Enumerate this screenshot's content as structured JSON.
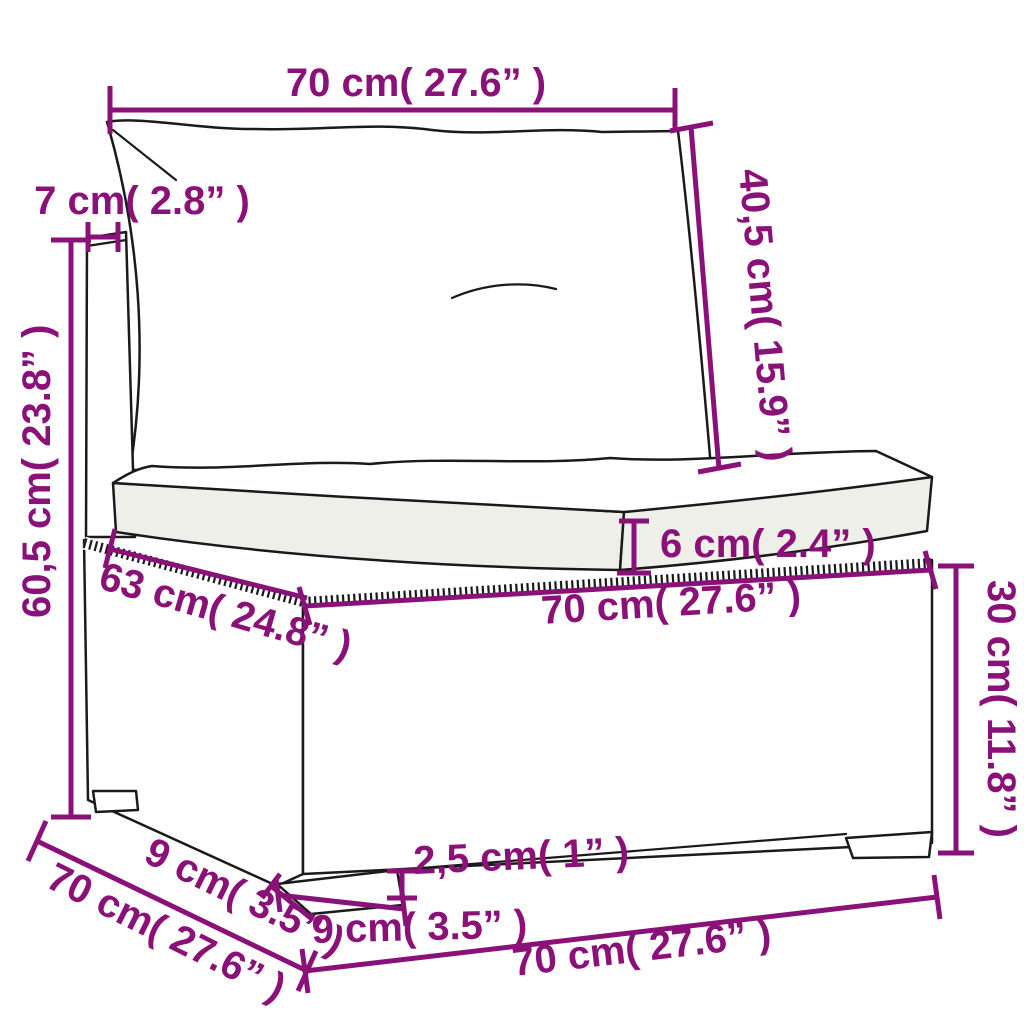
{
  "page": {
    "background": "#ffffff"
  },
  "diagram": {
    "type": "product-dimension-diagram",
    "subject": "poly rattan garden sofa middle section with cushions",
    "annotation_color": "#8A1177",
    "line_color": "#1a1a1a",
    "dimensions": {
      "top_width": "70 cm( 27.6” )",
      "back_cushion_height": "40,5 cm( 15.9” )",
      "back_post_width": "7 cm( 2.8” )",
      "total_height": "60,5 cm( 23.8” )",
      "seat_depth": "63 cm( 24.8” )",
      "seat_cushion_thickness": "6 cm( 2.4” )",
      "base_top_width": "70 cm( 27.6” )",
      "base_height": "30 cm( 11.8” )",
      "leg_height": "2,5 cm( 1” )",
      "front_leg_width": "9 cm( 3.5” )",
      "side_leg_depth": "9 cm( 3.5” )",
      "base_depth": "70 cm( 27.6” )",
      "bottom_width": "70 cm( 27.6” )"
    }
  }
}
